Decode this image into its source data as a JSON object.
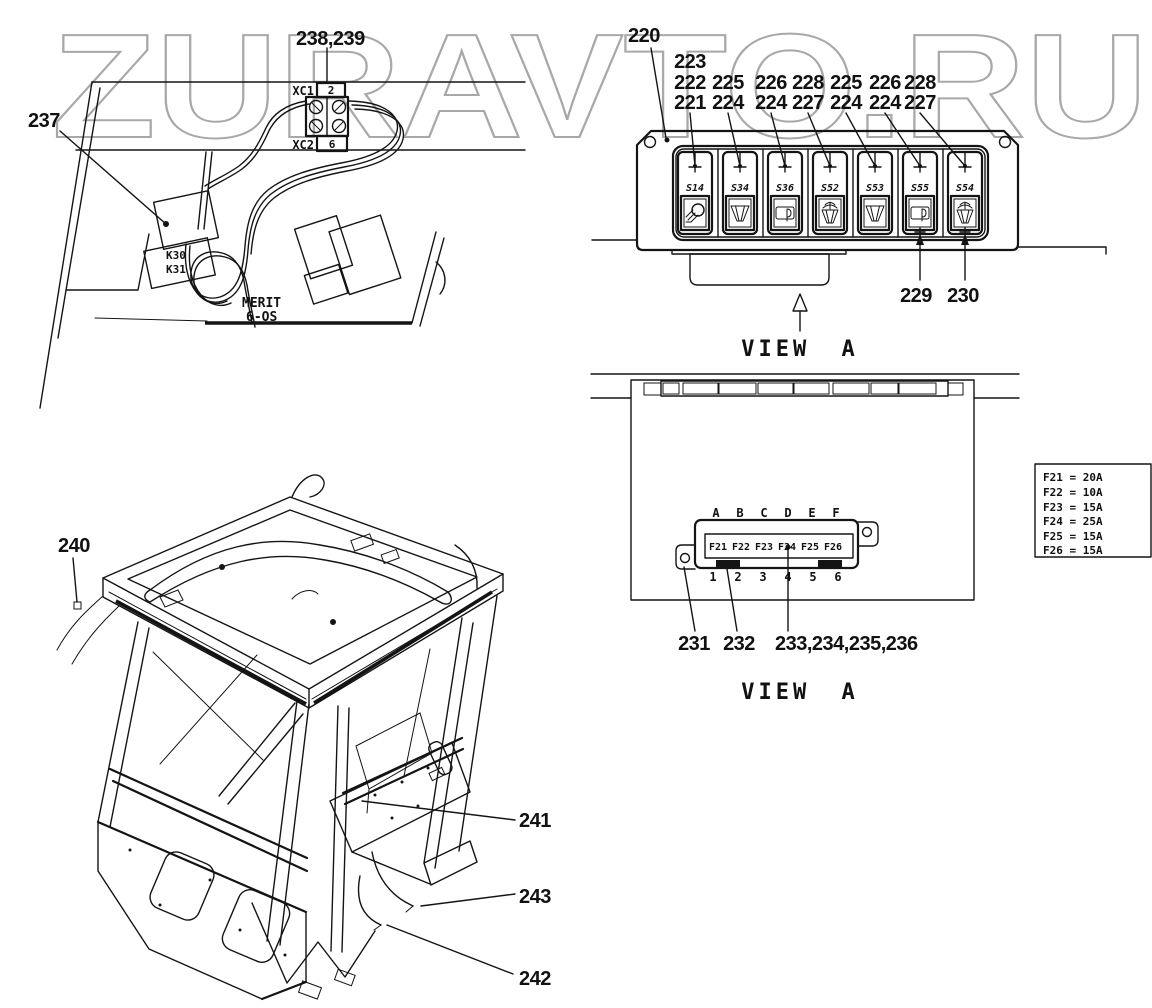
{
  "watermark": {
    "text": "ZURAVTO.RU",
    "color": "#a8a8a8"
  },
  "wiring_console": {
    "callout_238_239": "238,239",
    "callout_237": "237",
    "connector_top": {
      "label": "XC1",
      "pin": "2"
    },
    "connector_bottom": {
      "label": "XC2",
      "pin": "6"
    },
    "relay_line1": "K30",
    "relay_line2": "K31",
    "brand_line1": "MERIT",
    "brand_line2": "6-OS"
  },
  "switch_panel": {
    "callout_220": "220",
    "switches": [
      {
        "id": "S14",
        "icon": "work-light-icon",
        "callouts": [
          "223",
          "222",
          "221"
        ]
      },
      {
        "id": "S34",
        "icon": "wiper-icon",
        "callouts": [
          "225",
          "224"
        ]
      },
      {
        "id": "S36",
        "icon": "washer-icon",
        "callouts": [
          "226",
          "224"
        ]
      },
      {
        "id": "S52",
        "icon": "wiper-washer-icon",
        "callouts": [
          "228",
          "227"
        ]
      },
      {
        "id": "S53",
        "icon": "wiper-icon",
        "callouts": [
          "225",
          "224"
        ]
      },
      {
        "id": "S55",
        "icon": "washer-icon",
        "callouts": [
          "226",
          "224"
        ]
      },
      {
        "id": "S54",
        "icon": "wiper-washer-icon",
        "callouts": [
          "228",
          "227"
        ]
      }
    ],
    "callout_229": "229",
    "callout_230": "230",
    "view_label": "VIEW A"
  },
  "fuse_panel": {
    "slot_letters": [
      "A",
      "B",
      "C",
      "D",
      "E",
      "F"
    ],
    "fuse_names": [
      "F21",
      "F22",
      "F23",
      "F24",
      "F25",
      "F26"
    ],
    "slot_numbers": [
      "1",
      "2",
      "3",
      "4",
      "5",
      "6"
    ],
    "callout_231": "231",
    "callout_232": "232",
    "callout_233_236": "233,234,235,236",
    "view_label": "VIEW A",
    "fuse_table_rows": [
      "F21 = 20A",
      "F22 = 10A",
      "F23 = 15A",
      "F24 = 25A",
      "F25 = 15A",
      "F26 = 15A"
    ]
  },
  "cab_frame": {
    "callout_240": "240",
    "callout_241": "241",
    "callout_242": "242",
    "callout_243": "243"
  }
}
